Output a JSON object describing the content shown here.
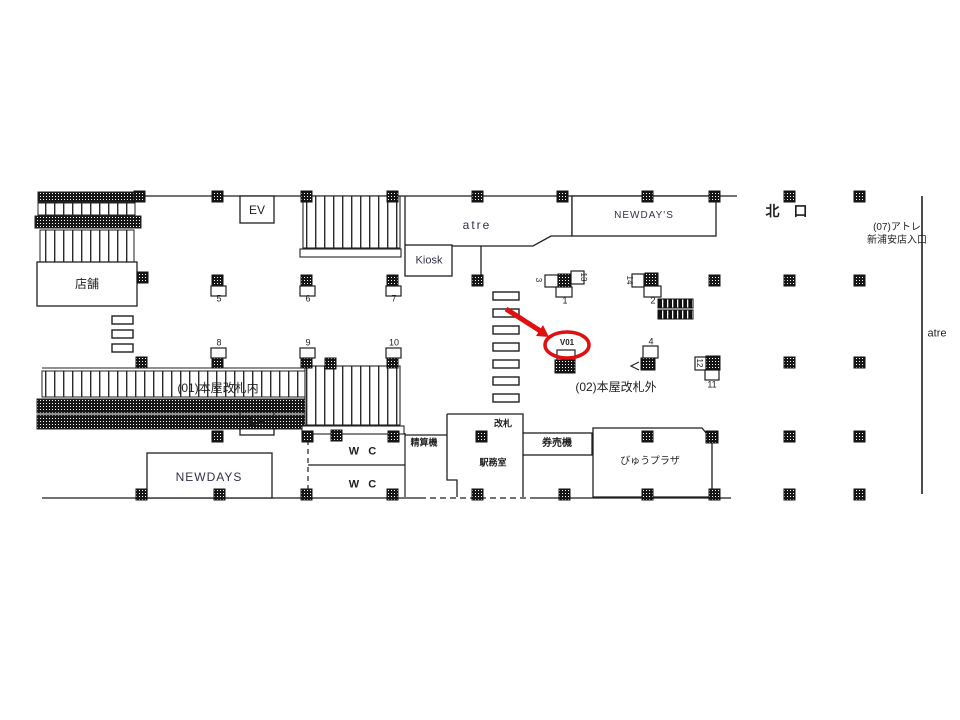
{
  "map": {
    "station_area_colors": {
      "line": "#1a1a1a",
      "highlight_red": "#e01010",
      "column_fill": "#111111"
    },
    "labels": {
      "store": "店舗",
      "ev": "EV",
      "atre": "atre",
      "kiosk": "Kiosk",
      "newdays_upper": "NEWDAY'S",
      "newdays_lower": "NEWDAYS",
      "north_exit": "北 口",
      "atre_entrance_line1": "(07)アトレ",
      "atre_entrance_line2": "新浦安店入口",
      "atre_right_edge": "atre",
      "zone_inside_gates": "(01)本屋改札内",
      "zone_outside_gates": "(02)本屋改札外",
      "ticket_gate": "改札",
      "station_office": "駅務室",
      "fare_adjustment_machine": "精算機",
      "ticket_vending_machine": "券売機",
      "view_plaza": "びゅうプラザ",
      "wc": "W C",
      "highlighted_position": "V01"
    },
    "ad_positions": {
      "p1": "1",
      "p2": "2",
      "p3": "3",
      "p4": "4",
      "p5": "5",
      "p6": "6",
      "p7": "7",
      "p8": "8",
      "p9": "9",
      "p10": "10",
      "p11": "11",
      "p12": "12",
      "p13": "13",
      "p14": "14"
    }
  }
}
